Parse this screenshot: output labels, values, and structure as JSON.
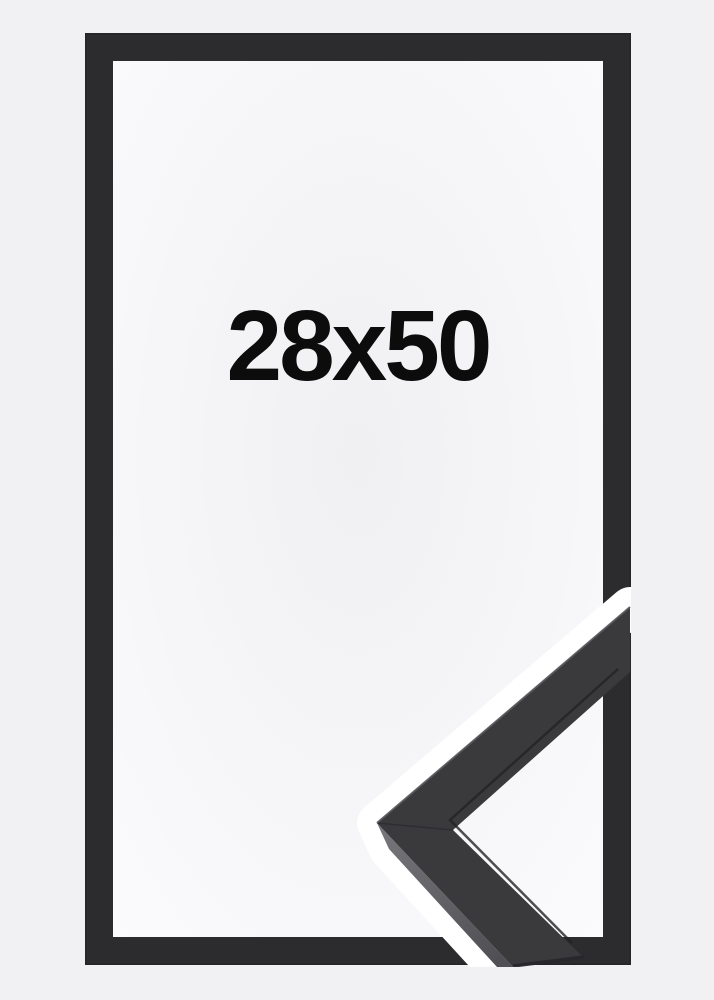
{
  "product_image": {
    "size_label": "28x50",
    "description_names": {
      "front_view": "frame-front-view",
      "corner_sample": "frame-corner-profile-3d"
    }
  },
  "colors": {
    "background": "#f1f1f3",
    "interior_center": "#f0f0f2",
    "interior_edge": "#fbfbfd",
    "frame": "#2c2c2e",
    "frame_edge_dark": "#222224",
    "halo": "#ffffff",
    "face": "#3a3a3d",
    "bevel_light": "#77777c",
    "bevel_dark": "#4f4f54",
    "edge_highlight": "#55555a",
    "lip_line": "#232326",
    "seam_line": "#2a2a2d",
    "end_cut": "#27272a",
    "text": "#0c0c0c"
  }
}
